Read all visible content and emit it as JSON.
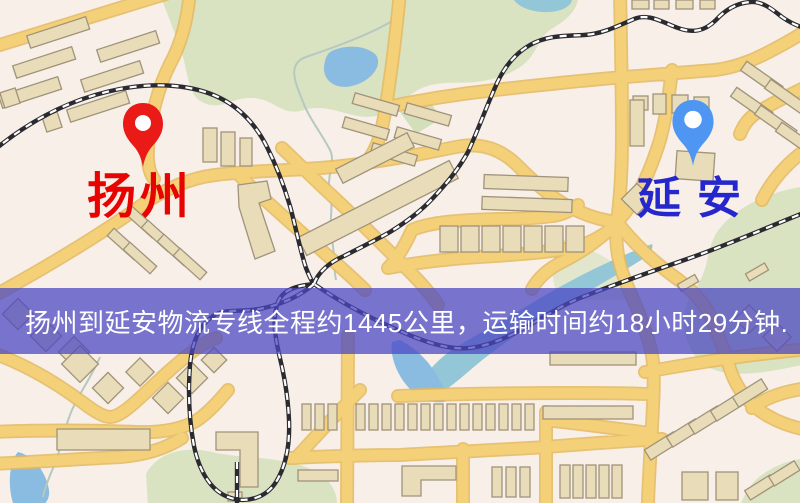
{
  "map": {
    "origin_marker": {
      "label": "扬州",
      "icon": "red-map-pin-icon",
      "pin_color": "#ea1b17",
      "label_color": "#e60300"
    },
    "destination_marker": {
      "label": "延安",
      "icon": "blue-map-pin-icon",
      "pin_color": "#4f96f2",
      "label_color": "#2526cc"
    }
  },
  "banner": {
    "text": "扬州到延安物流专线全程约1445公里，运输时间约18小时29分钟.",
    "route_from": "扬州",
    "route_to": "延安",
    "distance_text": "约1445公里",
    "duration_text": "约18小时29分钟",
    "background_color": "#4c48c4",
    "text_color": "#ffffff"
  },
  "palette": {
    "map_background": "#f7efe8",
    "road": "#f4d178",
    "road_casing": "#e4b95e",
    "park": "#d9e3c2",
    "water": "#8abce2",
    "building": "#e9dcb9",
    "railway": "#2a2a30"
  }
}
